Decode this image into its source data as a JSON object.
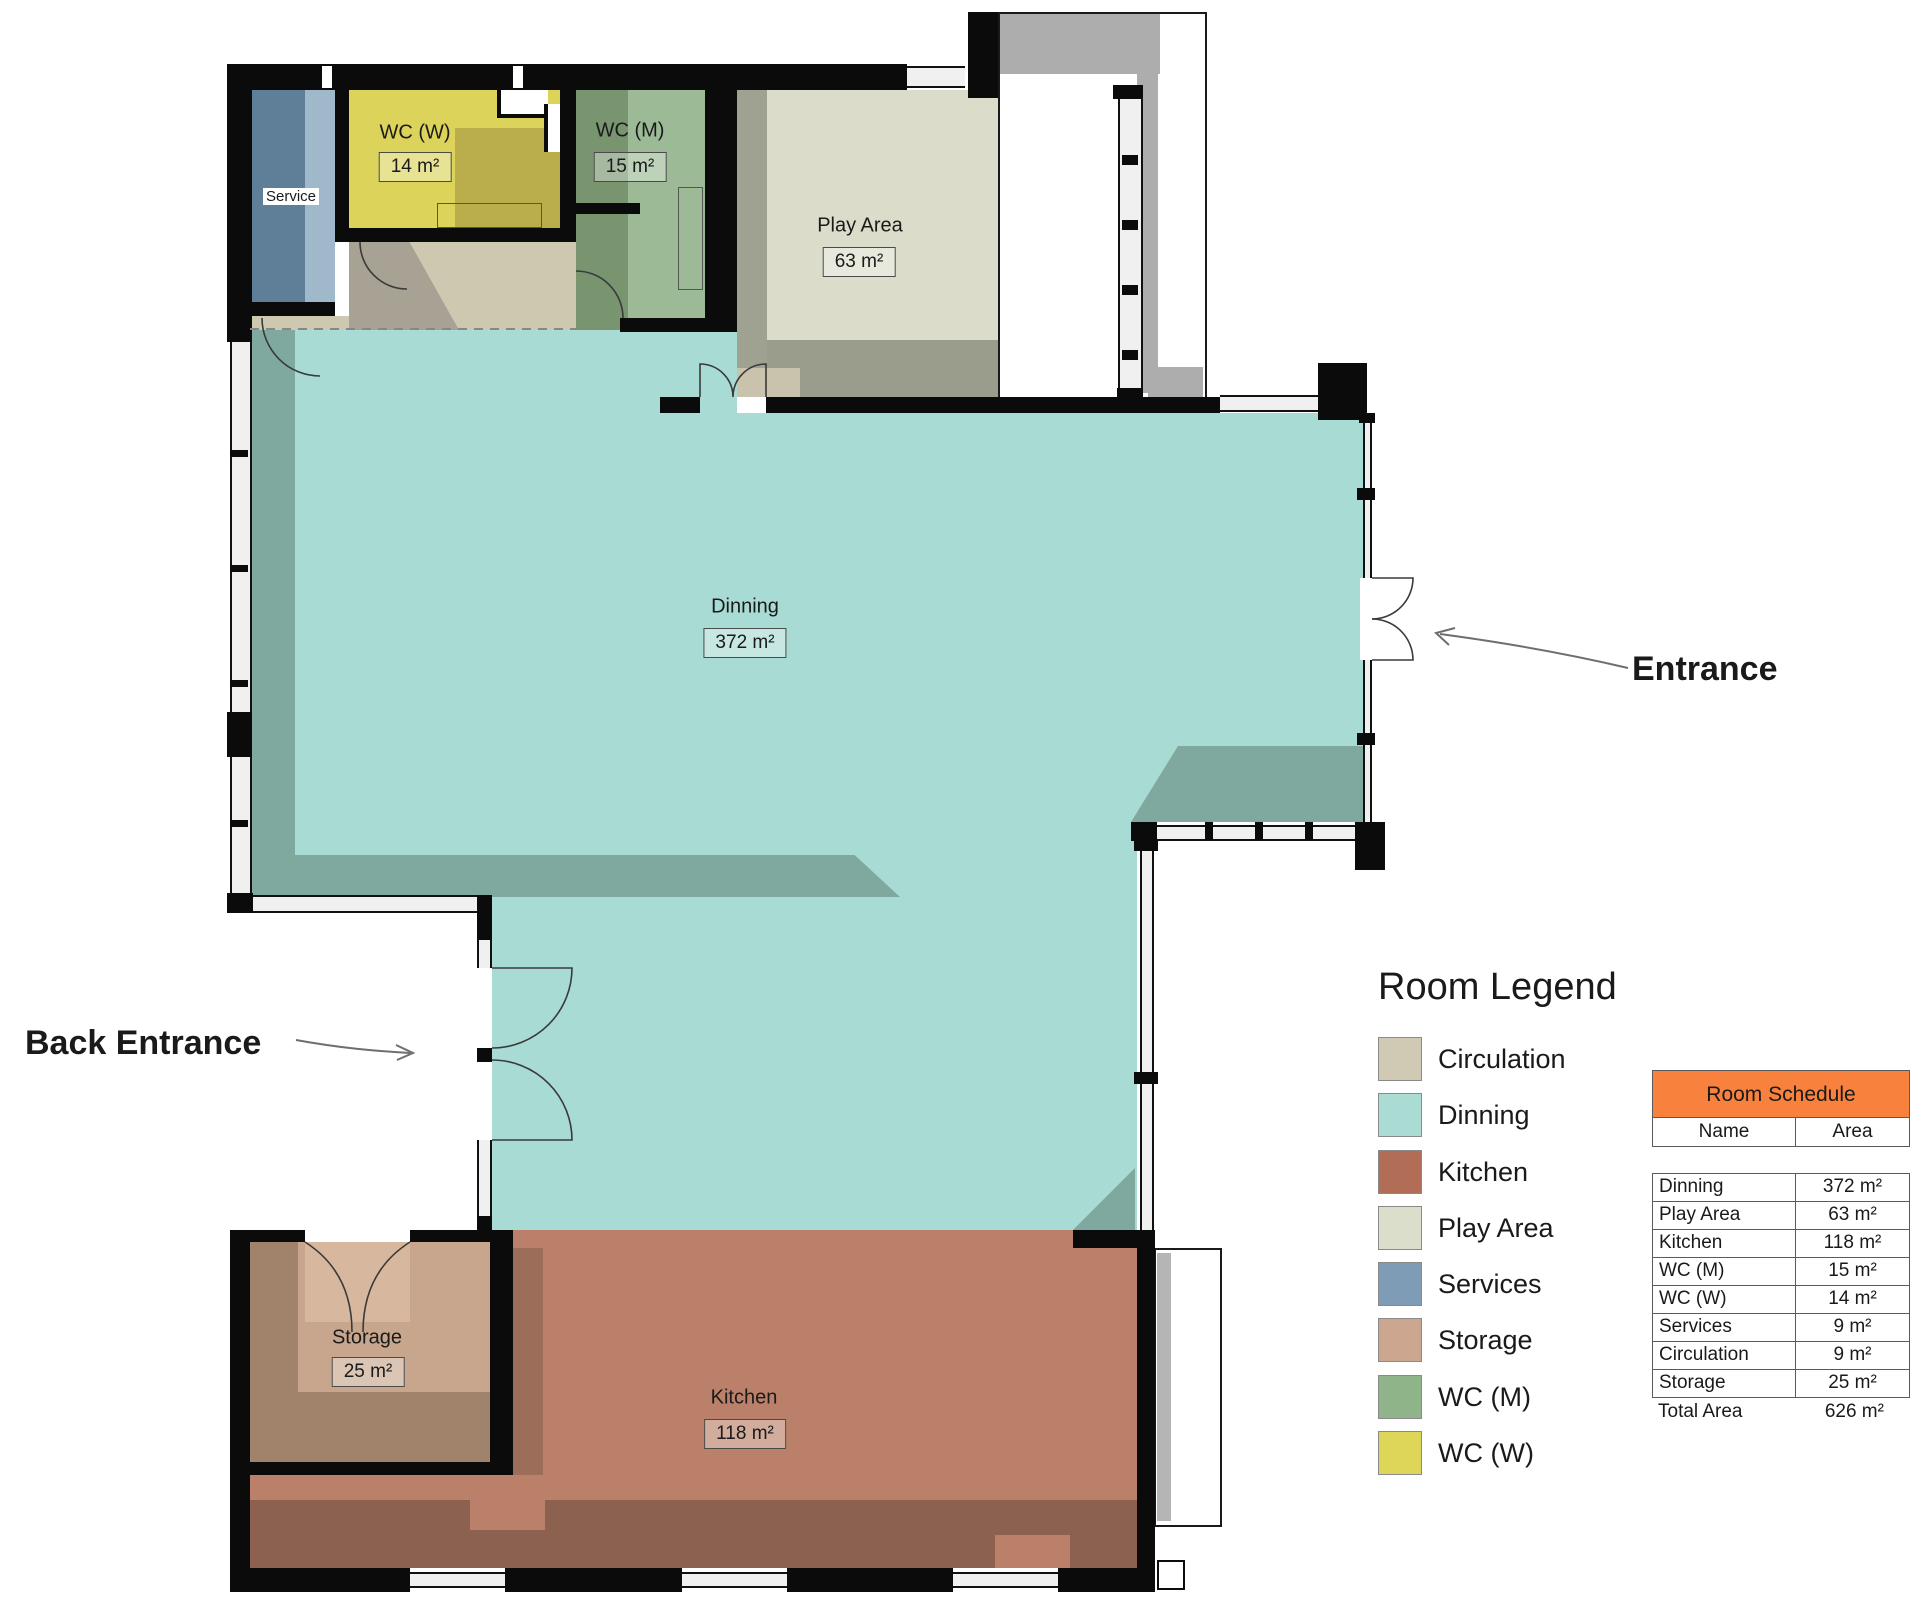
{
  "plan": {
    "rooms": {
      "service": {
        "label": "Service"
      },
      "wc_w": {
        "label": "WC (W)",
        "area": "14 m²"
      },
      "wc_m": {
        "label": "WC (M)",
        "area": "15 m²"
      },
      "play": {
        "label": "Play Area",
        "area": "63 m²"
      },
      "dinning": {
        "label": "Dinning",
        "area": "372 m²"
      },
      "storage": {
        "label": "Storage",
        "area": "25 m²"
      },
      "kitchen": {
        "label": "Kitchen",
        "area": "118 m²"
      }
    },
    "annotations": {
      "entrance": "Entrance",
      "back_entrance": "Back Entrance"
    },
    "colors": {
      "dinning": "#a8dbd3",
      "kitchen": "#ba8069",
      "play": "#dbddca",
      "circulation": "#cfc8b1",
      "services": "#5f7e98",
      "storage": "#c8a68e",
      "wc_m": "#9bba95",
      "wc_w": "#dcd35b",
      "wall": "#0b0b0b"
    }
  },
  "legend": {
    "title": "Room Legend",
    "items": [
      {
        "label": "Circulation",
        "color": "#d0cab4"
      },
      {
        "label": "Dinning",
        "color": "#abdcd3"
      },
      {
        "label": "Kitchen",
        "color": "#b26d57"
      },
      {
        "label": "Play Area",
        "color": "#dbdecb"
      },
      {
        "label": "Services",
        "color": "#7e9cb5"
      },
      {
        "label": "Storage",
        "color": "#cca68f"
      },
      {
        "label": "WC (M)",
        "color": "#8fb48a"
      },
      {
        "label": "WC (W)",
        "color": "#ded658"
      }
    ]
  },
  "schedule": {
    "title": "Room Schedule",
    "header_color": "#f8813e",
    "columns": [
      "Name",
      "Area"
    ],
    "rows": [
      [
        "Dinning",
        "372 m²"
      ],
      [
        "Play Area",
        "63 m²"
      ],
      [
        "Kitchen",
        "118 m²"
      ],
      [
        "WC (M)",
        "15 m²"
      ],
      [
        "WC (W)",
        "14 m²"
      ],
      [
        "Services",
        "9 m²"
      ],
      [
        "Circulation",
        "9 m²"
      ],
      [
        "Storage",
        "25 m²"
      ]
    ],
    "total": [
      "Total Area",
      "626 m²"
    ]
  }
}
